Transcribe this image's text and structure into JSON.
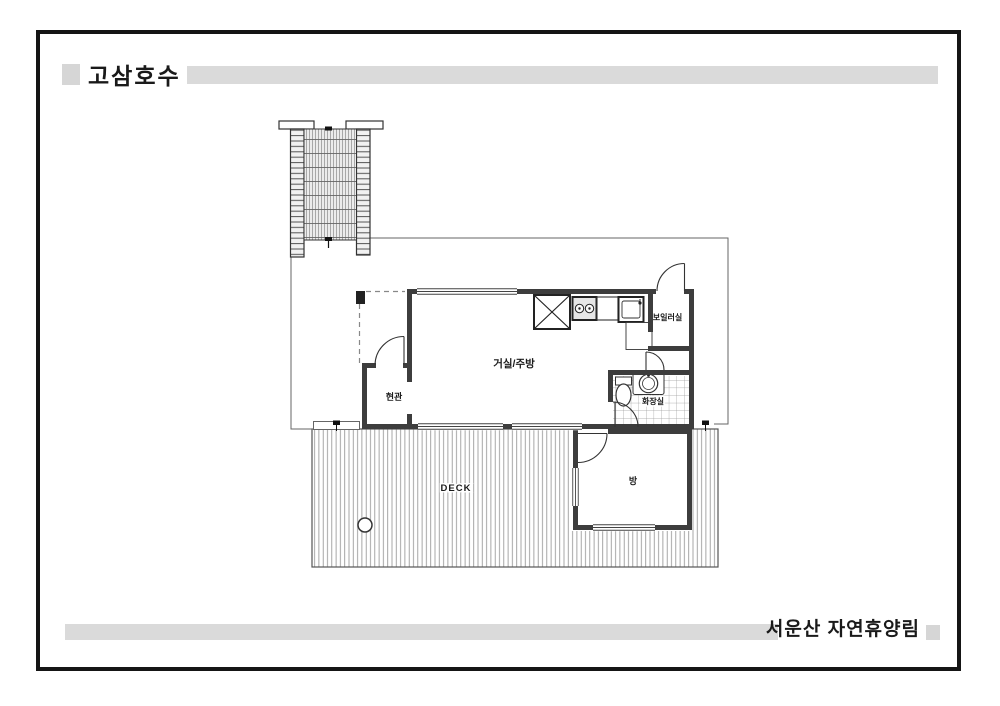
{
  "slide": {
    "header": {
      "title": "고삼호수"
    },
    "footer": {
      "title": "서운산 자연휴양림"
    }
  },
  "plan": {
    "labels": {
      "living_kitchen": "거실/주방",
      "entrance": "현관",
      "boiler_room": "보일러실",
      "bathroom": "화장실",
      "bedroom": "방",
      "deck": "DECK"
    }
  },
  "colors": {
    "accent_bar": "#dadada",
    "accent_square": "#d6d6d6",
    "frame_border": "#151515",
    "wall": "#3d3d3d",
    "deck_board_line": "#909090"
  }
}
